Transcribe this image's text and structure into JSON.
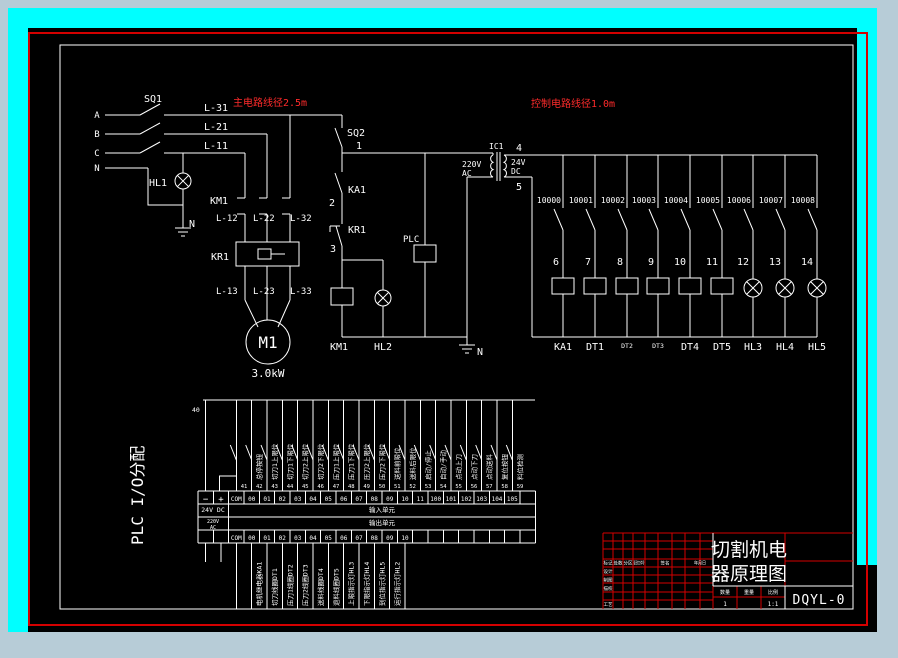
{
  "colors": {
    "frame_cyan": "#00ffff",
    "background": "#b7ccd7",
    "canvas": "#000000",
    "annotation_red": "#ff2b2b",
    "frame_red": "#d40000",
    "line_white": "#ffffff"
  },
  "annotations": {
    "main_wire_note": "主电路线径2.5m",
    "control_wire_note": "控制电路线径1.0m"
  },
  "power_circuit": {
    "phases": [
      "A",
      "B",
      "C",
      "N"
    ],
    "switch": "SQ1",
    "wires_top": [
      "L-31",
      "L-21",
      "L-11"
    ],
    "contactor": "KM1",
    "wires_mid": [
      "L-12",
      "L-22",
      "L-32"
    ],
    "thermal_relay": "KR1",
    "wires_bottom": [
      "L-13",
      "L-23",
      "L-33"
    ],
    "lamp": "HL1",
    "neutral": "N",
    "motor": "M1",
    "motor_rating": "3.0kW"
  },
  "control_circuit": {
    "switch": "SQ2",
    "relay_contact": "KA1",
    "thermal_contact": "KR1",
    "plc": "PLC",
    "contactor_coil": "KM1",
    "run_lamp": "HL2",
    "neutral": "N",
    "nodes": [
      "1",
      "2",
      "3",
      "4",
      "5"
    ],
    "transformer": {
      "name": "IC1",
      "primary_voltage": "220V",
      "primary_type": "AC",
      "secondary_voltage": "24V",
      "secondary_type": "DC"
    }
  },
  "ladder": {
    "plc_outputs": [
      "10000",
      "10001",
      "10002",
      "10003",
      "10004",
      "10005",
      "10006",
      "10007",
      "10008"
    ],
    "wire_nodes": [
      "6",
      "7",
      "8",
      "9",
      "10",
      "11",
      "12",
      "13",
      "14"
    ],
    "devices": [
      "KA1",
      "DT1",
      "DT2",
      "DT3",
      "DT4",
      "DT5",
      "HL3",
      "HL4",
      "HL5"
    ]
  },
  "io_table": {
    "section_title": "PLC  I/O分配",
    "bus_wire_number": "40",
    "wire_numbers": [
      "41",
      "42",
      "43",
      "44",
      "45",
      "46",
      "47",
      "48",
      "49",
      "50",
      "51",
      "52",
      "53",
      "54",
      "55",
      "56",
      "57",
      "58",
      "59"
    ],
    "input_terminals": [
      "−",
      "+",
      "COM",
      "00",
      "01",
      "02",
      "03",
      "04",
      "05",
      "06",
      "07",
      "08",
      "09",
      "10",
      "11",
      "100",
      "101",
      "102",
      "103",
      "104",
      "105"
    ],
    "input_labels": [
      "总停按钮",
      "切刀1上限位",
      "切刀1下限位",
      "切刀2上限位",
      "切刀2下限位",
      "压刀1上限位",
      "压刀1下限位",
      "压刀2上限位",
      "压刀2下限位",
      "送料前限位",
      "送料后限位",
      "启动/停止",
      "自动/手动",
      "点动上刀",
      "点动下刀",
      "点动送料",
      "复位按钮",
      "料位检测"
    ],
    "input_supply": "24V DC",
    "input_unit": "输入单元",
    "output_supply_1": "220V",
    "output_supply_2": "AC",
    "output_unit": "输出单元",
    "output_terminals": [
      "COM",
      "00",
      "01",
      "02",
      "03",
      "04",
      "05",
      "06",
      "07",
      "08",
      "09",
      "10"
    ],
    "output_labels": [
      "电机继电器KA1",
      "切刀线圈DT1",
      "压刀1线圈DT2",
      "压刀2线圈DT3",
      "送料线圈DT4",
      "退料线圈DT5",
      "上限指示灯HL3",
      "下限指示灯HL4",
      "到位指示灯HL5",
      "运行指示灯HL2"
    ]
  },
  "title_block": {
    "drawing_title_line1": "切割机电",
    "drawing_title_line2": "器原理图",
    "drawing_code": "DQYL-0",
    "header_cells": [
      "标记",
      "处数",
      "分区",
      "更改文件号",
      "签名",
      "年月日"
    ],
    "row_labels": [
      "设计",
      "制图",
      "描校",
      "工艺"
    ],
    "qty_label": "数量",
    "weight_label": "重量",
    "scale_label": "比例",
    "qty_value": "1",
    "scale_value": "1:1"
  }
}
